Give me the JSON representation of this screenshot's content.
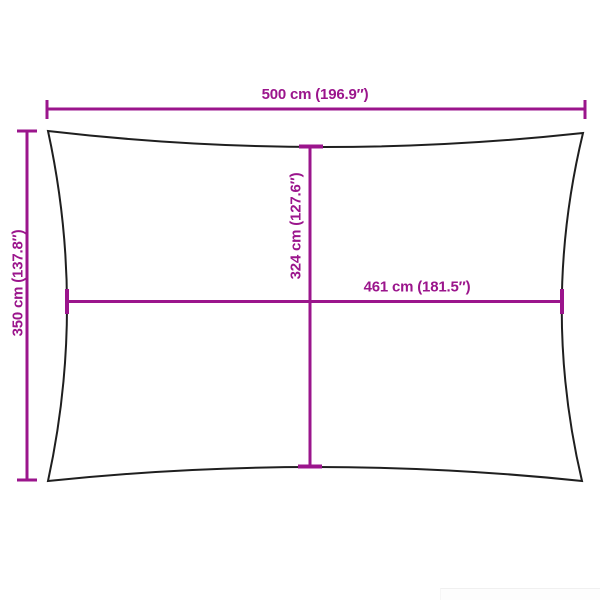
{
  "diagram": {
    "dimensions": {
      "top_width": "500 cm (196.9″)",
      "left_height": "350 cm (137.8″)",
      "inner_height": "324 cm (127.6″)",
      "inner_width": "461 cm (181.5″)"
    }
  },
  "colors": {
    "dimension": "#9b158c",
    "outline": "#1f1f1f",
    "background": "#ffffff"
  }
}
